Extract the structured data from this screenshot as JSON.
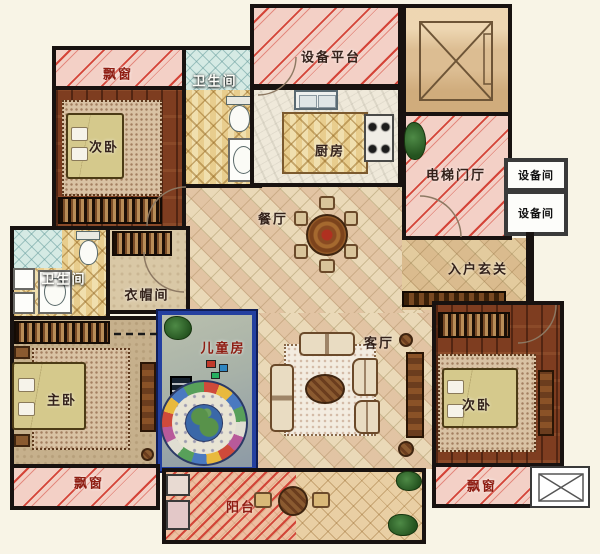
{
  "palette": {
    "background": "#f8f4e6",
    "wall": "#181210",
    "hatch_pink": "#f3d0c6",
    "hatch_red_stripe": "#d44438",
    "wood_floor": "#7e3d20",
    "tile_cream": "#ead9b8",
    "tile_gold": "#f0dfae",
    "tile_cyan": "#d5eae4",
    "kids_room_floor": "#a8b2a8",
    "kids_room_border": "#2440a0",
    "label_dark": "#33211a",
    "label_red": "#8e1d12",
    "label_white": "#fdfdf8"
  },
  "rooms": {
    "bay_window_top_left": {
      "label": "飘窗"
    },
    "bedroom_top_left": {
      "label": "次卧"
    },
    "bathroom_top": {
      "label": "卫生间"
    },
    "equipment_platform": {
      "label": "设备平台"
    },
    "kitchen": {
      "label": "厨房"
    },
    "elevator_hall": {
      "label": "电梯门厅"
    },
    "equipment_room_1": {
      "label": "设备间"
    },
    "equipment_room_2": {
      "label": "设备间"
    },
    "dining_room": {
      "label": "餐厅"
    },
    "entry_foyer": {
      "label": "入户玄关"
    },
    "bathroom_master": {
      "label": "卫生间"
    },
    "cloakroom": {
      "label": "衣帽间"
    },
    "children_room": {
      "label": "儿童房"
    },
    "living_room": {
      "label": "客厅"
    },
    "master_bedroom": {
      "label": "主卧"
    },
    "bedroom_right": {
      "label": "次卧"
    },
    "bay_window_bottom_left": {
      "label": "飘窗"
    },
    "bay_window_bottom_right": {
      "label": "飘窗"
    },
    "balcony": {
      "label": "阳台"
    }
  }
}
